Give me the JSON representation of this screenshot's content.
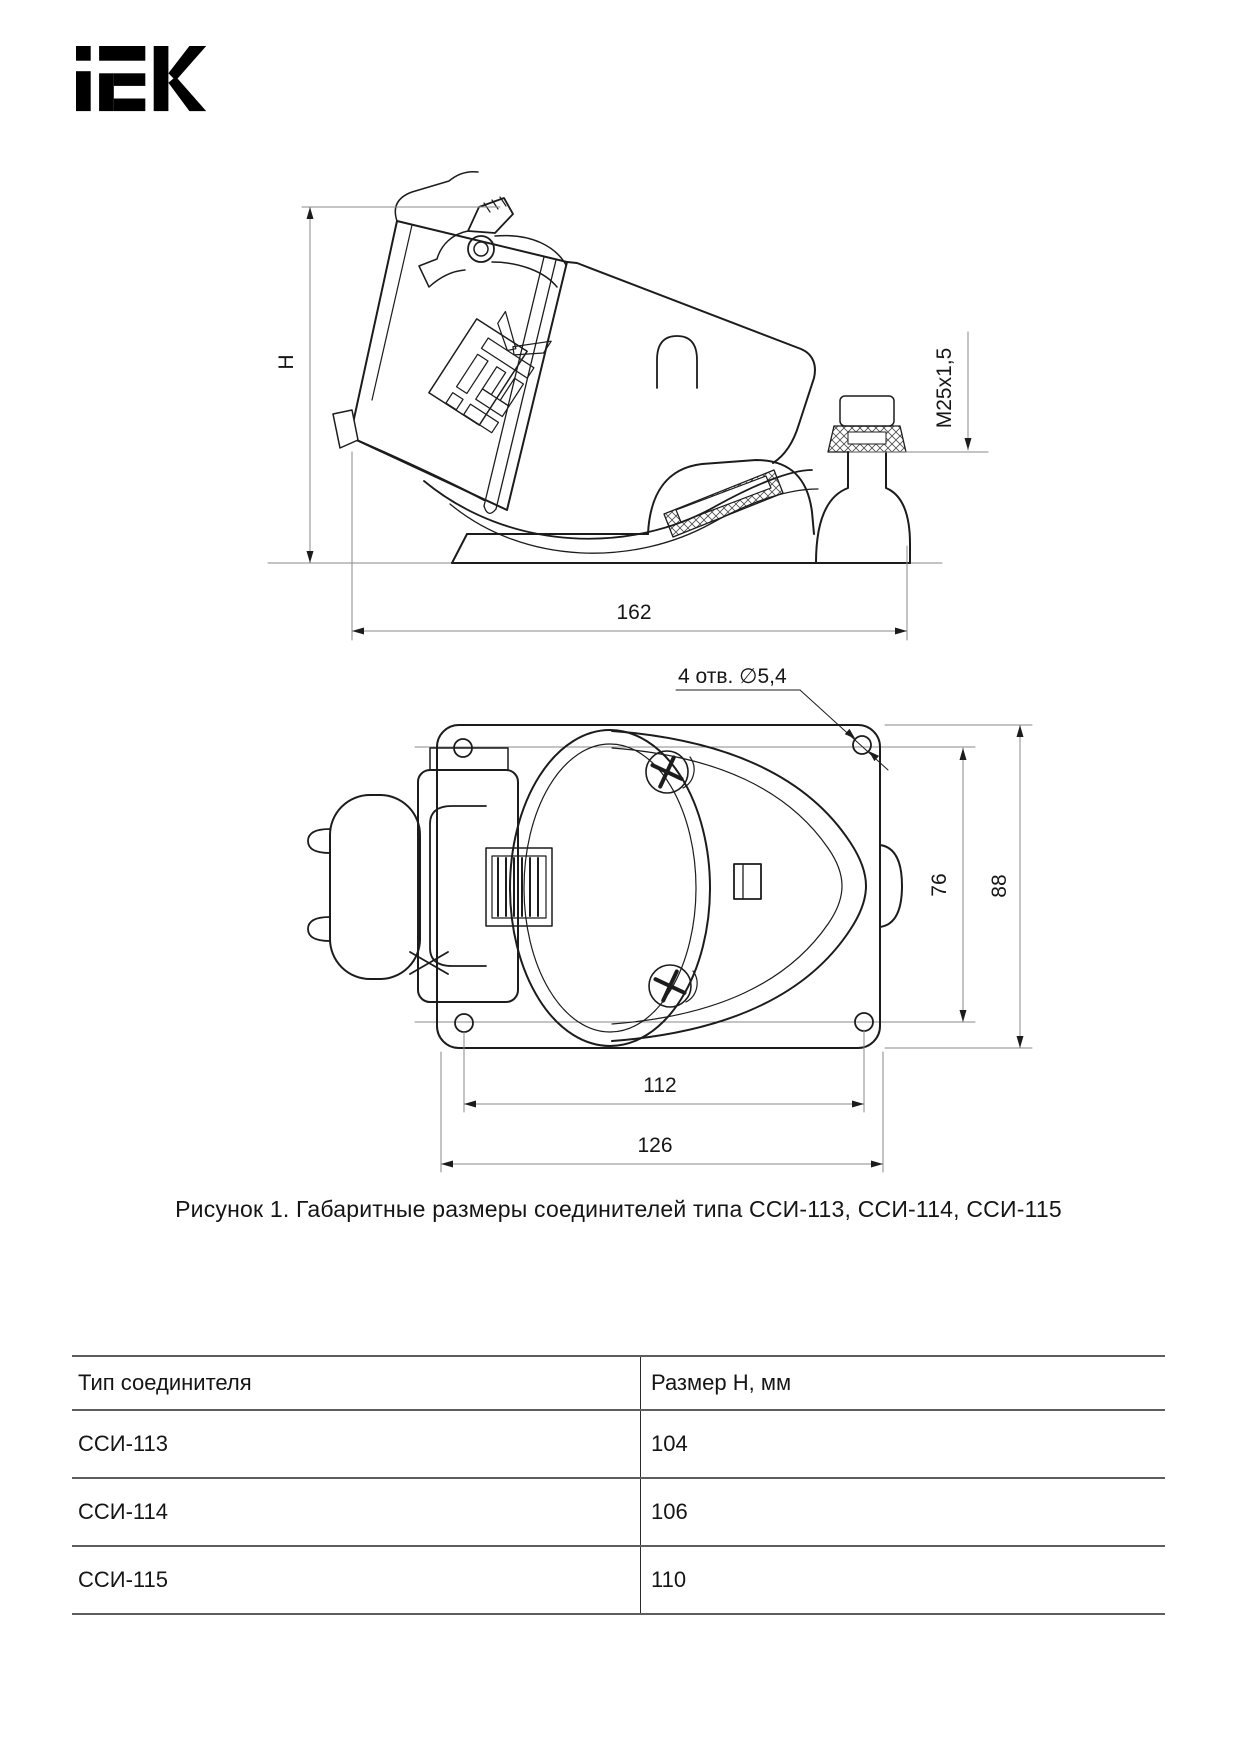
{
  "brand": {
    "logo_text": "iEK"
  },
  "figure": {
    "caption": "Рисунок 1. Габаритные размеры соединителей типа ССИ-113, ССИ-114, ССИ-115",
    "side_view": {
      "height_label": "H",
      "width_label": "162",
      "thread_label": "M25x1,5",
      "body_logo_text": "iEK"
    },
    "top_view": {
      "holes_label": "4 отв. ∅5,4",
      "hole_span_vertical": "76",
      "plate_height": "88",
      "hole_span_horizontal": "112",
      "plate_width": "126"
    }
  },
  "table": {
    "headers": [
      "Тип соединителя",
      "Размер Н, мм"
    ],
    "rows": [
      {
        "type": "ССИ-113",
        "h": "104"
      },
      {
        "type": "ССИ-114",
        "h": "106"
      },
      {
        "type": "ССИ-115",
        "h": "110"
      }
    ]
  },
  "colors": {
    "line": "#1c1c1c",
    "dim_line": "#8a8a8a",
    "text": "#111111"
  }
}
